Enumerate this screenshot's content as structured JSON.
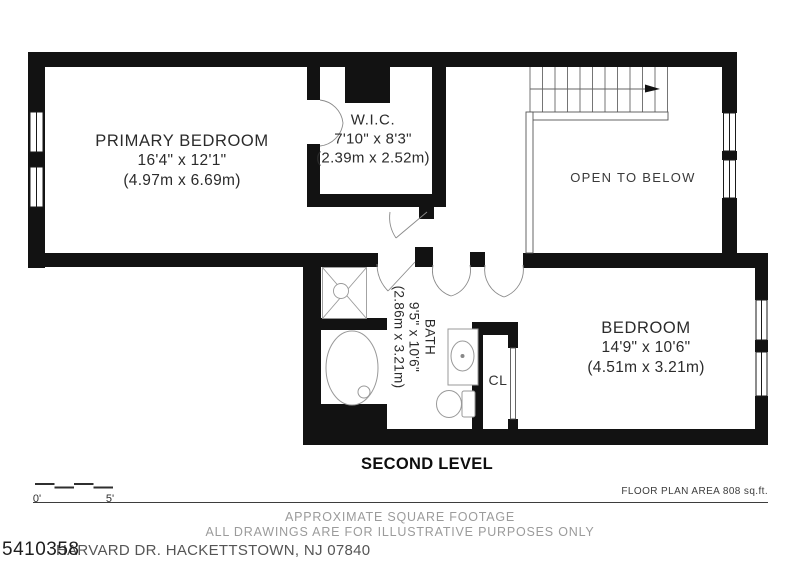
{
  "plan": {
    "level_title": "SECOND LEVEL",
    "primary_bedroom": {
      "name": "PRIMARY BEDROOM",
      "dims_ft": "16'4\" x 12'1\"",
      "dims_m": "(4.97m x 6.69m)"
    },
    "wic": {
      "name": "W.I.C.",
      "dims_ft": "7'10\" x 8'3\"",
      "dims_m": "(2.39m x 2.52m)"
    },
    "bedroom": {
      "name": "BEDROOM",
      "dims_ft": "14'9\" x 10'6\"",
      "dims_m": "(4.51m x 3.21m)"
    },
    "bath": {
      "name": "BATH",
      "dims_ft": "9'5\" x 10'6\"",
      "dims_m": "(2.86m x 3.21m)"
    },
    "open_to_below": "OPEN TO BELOW",
    "closet": "CL"
  },
  "scale_bar": {
    "start_label": "0'",
    "end_label": "5'"
  },
  "footer": {
    "floor_area": "FLOOR PLAN AREA 808 sq.ft.",
    "disclaimer_line1": "APPROXIMATE SQUARE FOOTAGE",
    "disclaimer_line2": "ALL DRAWINGS ARE FOR ILLUSTRATIVE PURPOSES ONLY",
    "listing_id": "5410358",
    "address": "HARVARD DR. HACKETTSTOWN, NJ 07840"
  },
  "colors": {
    "wall": "#121212",
    "thin_line": "#8a8a8a",
    "text_gray": "#9b9b9b"
  }
}
